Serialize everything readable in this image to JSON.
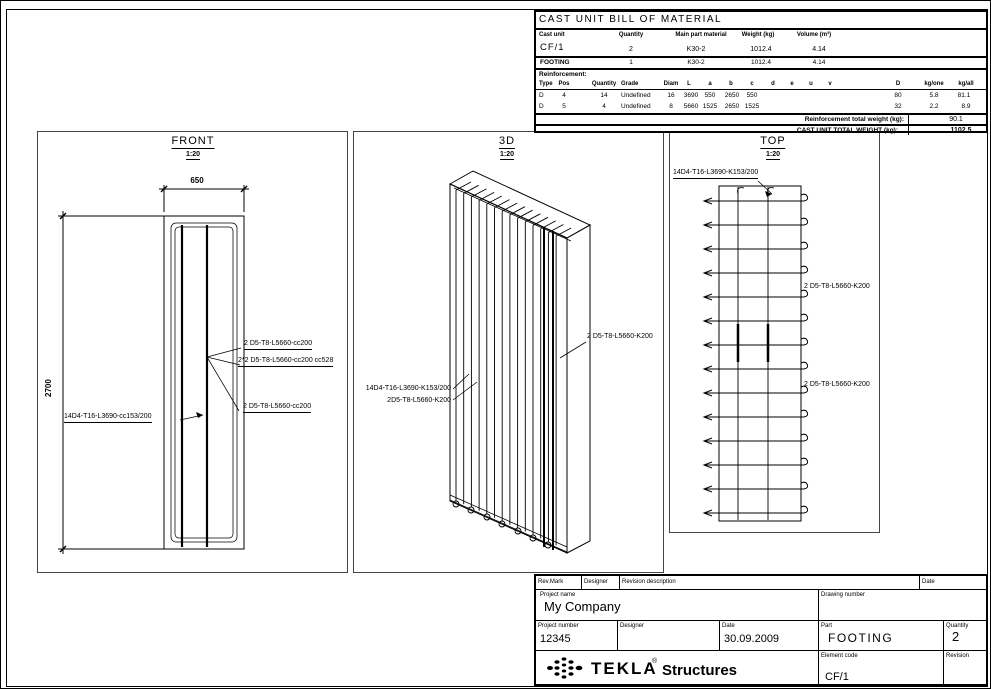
{
  "sheet": {
    "type": "cast unit drawing"
  },
  "bom": {
    "title": "CAST UNIT BILL OF MATERIAL",
    "cast_unit_headers": [
      "Cast unit",
      "Quantity",
      "Main part material",
      "Weight (kg)",
      "Volume (m³)"
    ],
    "cast_unit_rows": [
      [
        "CF/1",
        "2",
        "K30-2",
        "1012.4",
        "4.14"
      ],
      [
        "FOOTING",
        "1",
        "K30-2",
        "1012.4",
        "4.14"
      ]
    ],
    "reinforcement_label": "Reinforcement:",
    "reinf_headers": [
      "Type",
      "Pos",
      "Quantity",
      "Grade",
      "Diam",
      "L",
      "a",
      "b",
      "c",
      "d",
      "e",
      "u",
      "v",
      "D",
      "kg/one",
      "kg/all"
    ],
    "reinf_rows": [
      [
        "D",
        "4",
        "14",
        "Undefined",
        "16",
        "3690",
        "550",
        "2650",
        "550",
        "",
        "",
        "",
        "",
        "80",
        "5.8",
        "81.1"
      ],
      [
        "D",
        "5",
        "4",
        "Undefined",
        "8",
        "5660",
        "1525",
        "2650",
        "1525",
        "",
        "",
        "",
        "",
        "32",
        "2.2",
        "8.9"
      ]
    ],
    "reinf_total_label": "Reinforcement total weight (kg):",
    "reinf_total_value": "90.1",
    "grand_total_label": "CAST UNIT TOTAL WEIGHT (kg):",
    "grand_total_value": "1102.5"
  },
  "views": {
    "front": {
      "title": "FRONT",
      "scale": "1:20",
      "dim_width": "650",
      "dim_height": "2700",
      "labels": {
        "top": "2 D5-T8-L5660-cc200",
        "mid": "2*2 D5-T8-L5660-cc200 cc528",
        "bottom": "2 D5-T8-L5660-cc200",
        "main": "14D4-T16-L3690-cc153/200"
      }
    },
    "iso": {
      "title": "3D",
      "scale": "1:20",
      "labels": {
        "left1": "14D4-T16-L3690-K153/200",
        "left2": "2D5-T8-L5660-K200",
        "right": "2 D5-T8-L5660-K200"
      }
    },
    "top": {
      "title": "TOP",
      "scale": "1:20",
      "labels": {
        "main": "14D4-T16-L3690-K153/200",
        "right1": "2 D5-T8-L5660-K200",
        "right2": "2 D5-T8-L5660-K200"
      }
    }
  },
  "titleblock": {
    "rev_mark_label": "Rev.Mark",
    "designer_label": "Designer",
    "revision_description_label": "Revision description",
    "date_label": "Date",
    "project_name_label": "Project name",
    "project_name": "My Company",
    "drawing_number_label": "Drawing number",
    "project_number_label": "Project number",
    "project_number": "12345",
    "designer2_label": "Designer",
    "date2_label": "Date",
    "date_value": "30.09.2009",
    "part_label": "Part",
    "part_value": "FOOTING",
    "quantity_label": "Quantity",
    "quantity_value": "2",
    "element_code_label": "Element code",
    "element_code_value": "CF/1",
    "revision_label": "Revision",
    "logo_text": "TEKLA",
    "logo_reg": "®",
    "logo_sub": "Structures"
  }
}
